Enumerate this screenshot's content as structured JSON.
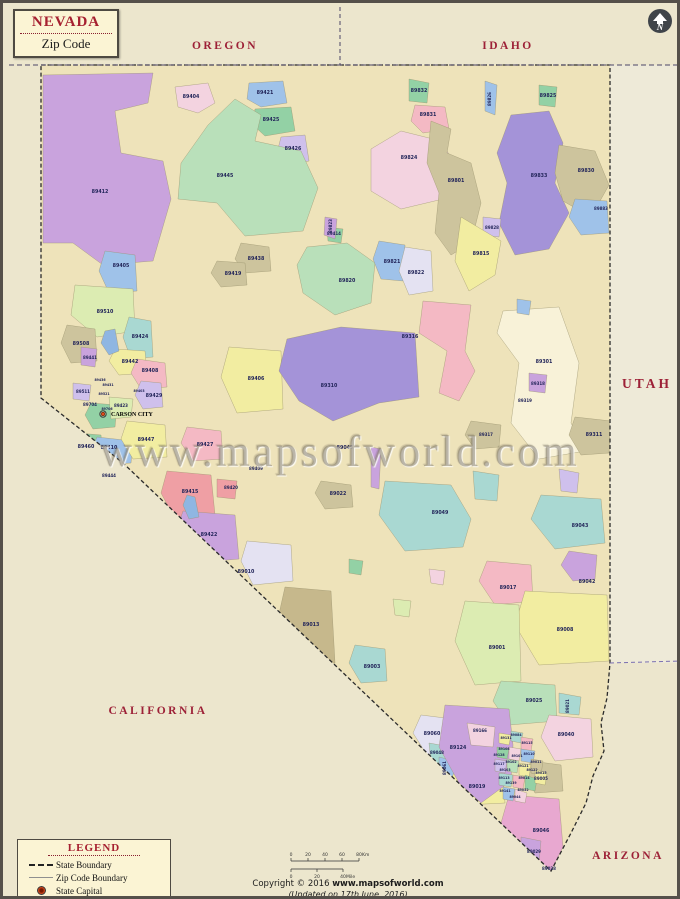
{
  "title": {
    "state": "NEVADA",
    "subtitle": "Zip Code"
  },
  "compass": {
    "letter": "N"
  },
  "watermark": {
    "text": "www.mapsofworld.com"
  },
  "legend": {
    "title": "LEGEND",
    "items": [
      {
        "symbol": "state-boundary",
        "label": "State Boundary"
      },
      {
        "symbol": "zip-code-boundary",
        "label": "Zip Code Boundary"
      },
      {
        "symbol": "state-capital",
        "label": "State Capital"
      }
    ]
  },
  "copyright": {
    "prefix": "Copyright © 2016 ",
    "site": "www.mapsofworld.com",
    "updated": "(Updated on 17th June, 2016)"
  },
  "capital": {
    "name": "CARSON CITY",
    "x": 100,
    "y": 411
  },
  "scale": {
    "x": 288,
    "bars": [
      {
        "y": 858,
        "w": 68,
        "labels": [
          "0",
          "20",
          "40",
          "60",
          "80"
        ],
        "unit": "Km",
        "side": "above"
      },
      {
        "y": 866,
        "w": 52,
        "labels": [
          "0",
          "20",
          "40"
        ],
        "unit": "Mile",
        "side": "below"
      }
    ]
  },
  "colors": {
    "page_bg": "#ece6cd",
    "nevada_fill": "#eee3ba",
    "utah_fill": "#eeead8",
    "accent_red": "#9d2137",
    "zip_label_navy": "#23265a",
    "border_gray": "#55504a",
    "watermark_gray": "#7d7662"
  },
  "map": {
    "palette": [
      "#c9a3dd",
      "#b9e0ba",
      "#f4b9c4",
      "#f2eda1",
      "#9fc2e9",
      "#a9d8d2",
      "#cdc49d",
      "#cfc0ec",
      "#f3d3e0",
      "#dcecb2",
      "#e4e2f2",
      "#93d1a5",
      "#c6b88c",
      "#ef9fa4",
      "#f8f2d8",
      "#a493d8",
      "#e8a8d0",
      "#8fb6e2"
    ],
    "state_labels": [
      {
        "t": "OREGON",
        "x": 222,
        "y": 46
      },
      {
        "t": "IDAHO",
        "x": 505,
        "y": 46
      },
      {
        "t": "UTAH",
        "x": 644,
        "y": 385,
        "big": 1
      },
      {
        "t": "CALIFORNIA",
        "x": 155,
        "y": 711
      },
      {
        "t": "ARIZONA",
        "x": 625,
        "y": 856
      }
    ],
    "zip_labels": [
      {
        "t": "89412",
        "x": 97,
        "y": 190
      },
      {
        "t": "89404",
        "x": 188,
        "y": 95
      },
      {
        "t": "89421",
        "x": 262,
        "y": 91
      },
      {
        "t": "89425",
        "x": 268,
        "y": 118
      },
      {
        "t": "89426",
        "x": 290,
        "y": 147
      },
      {
        "t": "89445",
        "x": 222,
        "y": 174
      },
      {
        "t": "89414",
        "x": 331,
        "y": 232,
        "c": "s"
      },
      {
        "t": "89832",
        "x": 416,
        "y": 89
      },
      {
        "t": "89831",
        "x": 425,
        "y": 113
      },
      {
        "t": "89826",
        "x": 488,
        "y": 96,
        "r": 1,
        "c": "s"
      },
      {
        "t": "89825",
        "x": 545,
        "y": 94
      },
      {
        "t": "89824",
        "x": 406,
        "y": 156
      },
      {
        "t": "89801",
        "x": 453,
        "y": 179
      },
      {
        "t": "89833",
        "x": 536,
        "y": 174
      },
      {
        "t": "89830",
        "x": 583,
        "y": 169
      },
      {
        "t": "89883",
        "x": 598,
        "y": 207,
        "c": "s"
      },
      {
        "t": "89828",
        "x": 489,
        "y": 226,
        "c": "s"
      },
      {
        "t": "89815",
        "x": 478,
        "y": 252
      },
      {
        "t": "89823",
        "x": 329,
        "y": 223,
        "r": 1,
        "c": "s"
      },
      {
        "t": "89438",
        "x": 253,
        "y": 257
      },
      {
        "t": "89820",
        "x": 344,
        "y": 279
      },
      {
        "t": "89821",
        "x": 389,
        "y": 260
      },
      {
        "t": "89822",
        "x": 413,
        "y": 271
      },
      {
        "t": "89419",
        "x": 230,
        "y": 272
      },
      {
        "t": "89405",
        "x": 118,
        "y": 264
      },
      {
        "t": "89510",
        "x": 102,
        "y": 310
      },
      {
        "t": "89424",
        "x": 137,
        "y": 335
      },
      {
        "t": "89508",
        "x": 78,
        "y": 342
      },
      {
        "t": "89441",
        "x": 87,
        "y": 356,
        "c": "s"
      },
      {
        "t": "89442",
        "x": 127,
        "y": 360
      },
      {
        "t": "89408",
        "x": 147,
        "y": 369
      },
      {
        "t": "89436",
        "x": 97,
        "y": 378,
        "c": "xs"
      },
      {
        "t": "89431",
        "x": 105,
        "y": 383,
        "c": "xs"
      },
      {
        "t": "89511",
        "x": 80,
        "y": 390,
        "c": "s"
      },
      {
        "t": "89521",
        "x": 101,
        "y": 392,
        "c": "xs"
      },
      {
        "t": "89429",
        "x": 151,
        "y": 394
      },
      {
        "t": "89403",
        "x": 136,
        "y": 389,
        "c": "xs"
      },
      {
        "t": "89704",
        "x": 87,
        "y": 403,
        "c": "s"
      },
      {
        "t": "89706",
        "x": 104,
        "y": 407,
        "c": "xs"
      },
      {
        "t": "89423",
        "x": 118,
        "y": 404,
        "c": "s"
      },
      {
        "t": "89460",
        "x": 83,
        "y": 445
      },
      {
        "t": "89410",
        "x": 106,
        "y": 446
      },
      {
        "t": "89444",
        "x": 106,
        "y": 474,
        "c": "s"
      },
      {
        "t": "89447",
        "x": 143,
        "y": 438
      },
      {
        "t": "89427",
        "x": 202,
        "y": 443
      },
      {
        "t": "89406",
        "x": 253,
        "y": 377
      },
      {
        "t": "89310",
        "x": 326,
        "y": 384
      },
      {
        "t": "89316",
        "x": 407,
        "y": 335
      },
      {
        "t": "89301",
        "x": 541,
        "y": 360
      },
      {
        "t": "89318",
        "x": 535,
        "y": 382,
        "c": "s"
      },
      {
        "t": "89319",
        "x": 522,
        "y": 399,
        "c": "s"
      },
      {
        "t": "89311",
        "x": 591,
        "y": 433
      },
      {
        "t": "89317",
        "x": 483,
        "y": 433,
        "c": "s"
      },
      {
        "t": "89415",
        "x": 187,
        "y": 490
      },
      {
        "t": "89420",
        "x": 228,
        "y": 486,
        "c": "s"
      },
      {
        "t": "89422",
        "x": 206,
        "y": 533
      },
      {
        "t": "89010",
        "x": 243,
        "y": 570
      },
      {
        "t": "89013",
        "x": 308,
        "y": 623
      },
      {
        "t": "89022",
        "x": 335,
        "y": 492
      },
      {
        "t": "89045",
        "x": 342,
        "y": 446
      },
      {
        "t": "89409",
        "x": 253,
        "y": 467,
        "c": "s"
      },
      {
        "t": "89049",
        "x": 437,
        "y": 511
      },
      {
        "t": "89043",
        "x": 577,
        "y": 524
      },
      {
        "t": "89042",
        "x": 584,
        "y": 580
      },
      {
        "t": "89017",
        "x": 505,
        "y": 586
      },
      {
        "t": "89008",
        "x": 562,
        "y": 628
      },
      {
        "t": "89001",
        "x": 494,
        "y": 646
      },
      {
        "t": "89003",
        "x": 369,
        "y": 665
      },
      {
        "t": "89025",
        "x": 531,
        "y": 699
      },
      {
        "t": "89021",
        "x": 566,
        "y": 703,
        "r": 1,
        "c": "s"
      },
      {
        "t": "89040",
        "x": 563,
        "y": 733
      },
      {
        "t": "89060",
        "x": 429,
        "y": 732
      },
      {
        "t": "89048",
        "x": 434,
        "y": 751,
        "c": "s"
      },
      {
        "t": "89061",
        "x": 443,
        "y": 765,
        "r": 1,
        "c": "s"
      },
      {
        "t": "89124",
        "x": 455,
        "y": 746
      },
      {
        "t": "89166",
        "x": 477,
        "y": 729,
        "c": "s"
      },
      {
        "t": "89019",
        "x": 474,
        "y": 785
      },
      {
        "t": "89005",
        "x": 538,
        "y": 777,
        "c": "s"
      },
      {
        "t": "89046",
        "x": 538,
        "y": 829
      },
      {
        "t": "89029",
        "x": 531,
        "y": 850,
        "c": "s"
      },
      {
        "t": "89028",
        "x": 546,
        "y": 867,
        "c": "s"
      },
      {
        "t": "89131",
        "x": 503,
        "y": 736,
        "c": "xs"
      },
      {
        "t": "89084",
        "x": 513,
        "y": 733,
        "c": "xs"
      },
      {
        "t": "89115",
        "x": 524,
        "y": 741,
        "c": "xs"
      },
      {
        "t": "89108",
        "x": 501,
        "y": 747,
        "c": "xs"
      },
      {
        "t": "89128",
        "x": 496,
        "y": 753,
        "c": "xs"
      },
      {
        "t": "89110",
        "x": 526,
        "y": 752,
        "c": "xs"
      },
      {
        "t": "89101",
        "x": 514,
        "y": 754,
        "c": "xs"
      },
      {
        "t": "89117",
        "x": 496,
        "y": 762,
        "c": "xs"
      },
      {
        "t": "89102",
        "x": 508,
        "y": 760,
        "c": "xs"
      },
      {
        "t": "89121",
        "x": 520,
        "y": 764,
        "c": "xs"
      },
      {
        "t": "89103",
        "x": 502,
        "y": 768,
        "c": "xs"
      },
      {
        "t": "89122",
        "x": 529,
        "y": 768,
        "c": "xs"
      },
      {
        "t": "89113",
        "x": 501,
        "y": 776,
        "c": "xs"
      },
      {
        "t": "89014",
        "x": 521,
        "y": 776,
        "c": "xs"
      },
      {
        "t": "89139",
        "x": 508,
        "y": 781,
        "c": "xs"
      },
      {
        "t": "89052",
        "x": 520,
        "y": 788,
        "c": "xs"
      },
      {
        "t": "89141",
        "x": 502,
        "y": 789,
        "c": "xs"
      },
      {
        "t": "89044",
        "x": 512,
        "y": 795,
        "c": "xs"
      },
      {
        "t": "89011",
        "x": 533,
        "y": 760,
        "c": "xs"
      },
      {
        "t": "89015",
        "x": 538,
        "y": 771,
        "c": "xs"
      }
    ]
  }
}
